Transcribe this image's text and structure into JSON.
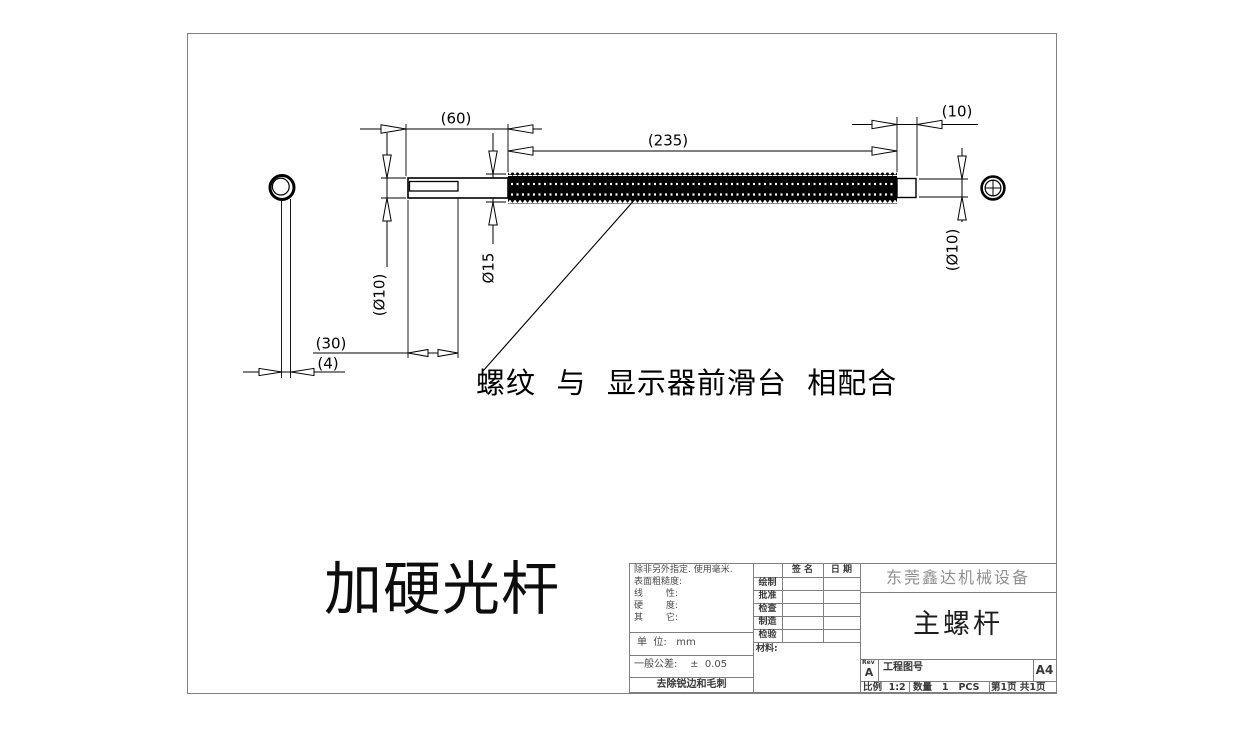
{
  "colors": {
    "drawing_line": "#000000",
    "frame_line": "#7f7f7f",
    "label_text": "#4a4a4a",
    "company_text": "#8f8f8f"
  },
  "drawing": {
    "dims": {
      "d60": "(60)",
      "d235": "(235)",
      "d10": "(10)",
      "dia10_left": "(Ø10)",
      "dia15": "Ø15",
      "dia10_right": "(Ø10)",
      "d30": "(30)",
      "d4": "(4)"
    },
    "note": "螺纹  与  显示器前滑台  相配合",
    "caption": "加硬光杆"
  },
  "title_block": {
    "notes": [
      "除非另外指定. 使用毫米.",
      "表面粗糙度:",
      "线        性:",
      "硬        度:",
      "其        它:"
    ],
    "unit": "单  位:   mm",
    "tolerance": "一般公差:    ±  0.05",
    "deburr": "去除锐边和毛刺",
    "sign_header": "签 名",
    "date_header": "日 期",
    "approval_rows": [
      "绘制",
      "批准",
      "检查",
      "制造",
      "检验"
    ],
    "material_label": "材料:",
    "company": "东莞鑫达机械设备",
    "part_name": "主螺杆",
    "rev_label": "Rev",
    "rev_value": "A",
    "drawing_no_label": "工程图号",
    "paper_size": "A4",
    "scale": "比例  1:2",
    "quantity": "数量   1   PCS",
    "sheet": "第1页 共1页"
  }
}
